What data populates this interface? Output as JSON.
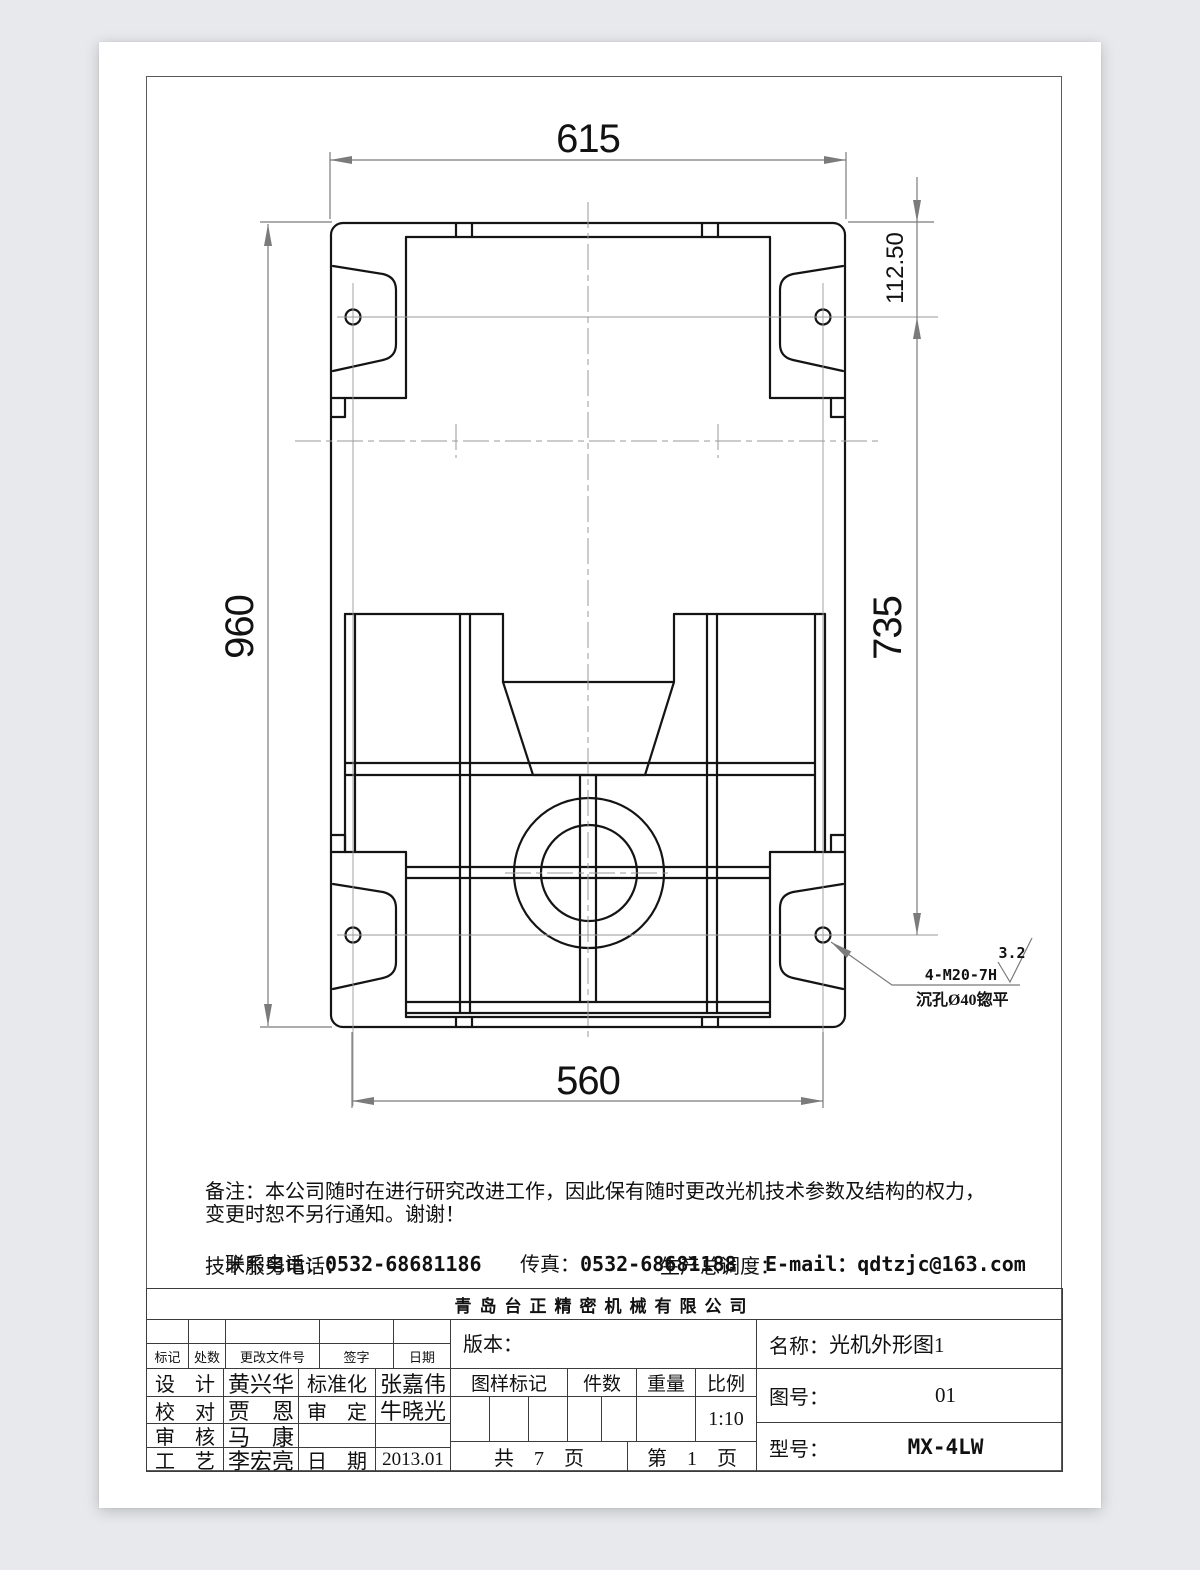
{
  "drawing": {
    "dims": {
      "width_top": "615",
      "height_left": "960",
      "height_right": "735",
      "offset_right": "112.50",
      "width_bottom": "560"
    },
    "leader": {
      "thread_spec": "4-M20-7H",
      "counterbore": "沉孔Ø40锪平",
      "roughness": "3.2"
    }
  },
  "notes": {
    "line1": "备注：本公司随时在进行研究改进工作，因此保有随时更改光机技术参数及结构的权力，",
    "line2": "变更时恕不另行通知。谢谢！",
    "contact_label": "联系电话：",
    "contact_phone": "0532-68681186",
    "fax_label": "传真：",
    "fax_phone": "0532-68681188",
    "email_label": "E-mail：",
    "email": "qdtzjc@163.com",
    "service_label": "技术服务电话：",
    "dispatch_label": "生产总调度："
  },
  "company": "青岛台正精密机械有限公司",
  "titleblock": {
    "rev_header": [
      "标记",
      "处数",
      "更改文件号",
      "签字",
      "日期"
    ],
    "sign_rows": [
      {
        "role": "设　计",
        "name": "黄兴华",
        "role2": "标准化",
        "value": "张嘉伟"
      },
      {
        "role": "校　对",
        "name": "贾　恩",
        "role2": "审　定",
        "value": "牛晓光"
      },
      {
        "role": "审　核",
        "name": "马　康",
        "role2": "",
        "value": ""
      },
      {
        "role": "工　艺",
        "name": "李宏亮",
        "role2": "日　期",
        "value": "2013.01"
      }
    ],
    "version_label": "版本：",
    "mark_header": [
      "图样标记",
      "件数",
      "重量",
      "比例"
    ],
    "scale": "1:10",
    "pages_total": "共　7　页",
    "page_no": "第　1　页",
    "name_label": "名称：",
    "name": "光机外形图1",
    "drawing_no_label": "图号：",
    "drawing_no": "01",
    "model_label": "型号：",
    "model": "MX-4LW"
  }
}
